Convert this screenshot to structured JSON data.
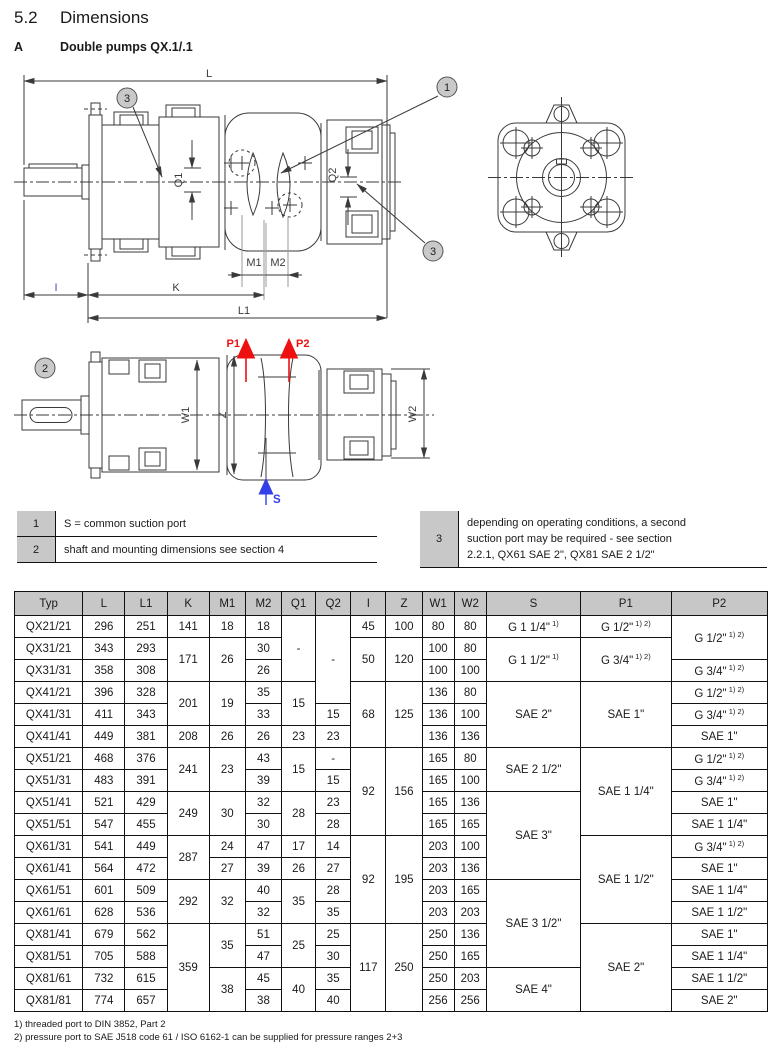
{
  "header": {
    "section_number": "5.2",
    "section_title": "Dimensions",
    "variant_letter": "A",
    "variant_title": "Double pumps QX.1/.1"
  },
  "drawing": {
    "dims": {
      "L": "L",
      "L1": "L1",
      "K": "K",
      "I": "I",
      "M1": "M1",
      "M2": "M2",
      "Q1": "Q1",
      "Q2": "Q2",
      "W1": "W1",
      "W2": "W2",
      "Z": "Z"
    },
    "ports": {
      "P1": "P1",
      "P2": "P2",
      "S": "S"
    },
    "callouts": {
      "c1": "1",
      "c2": "2",
      "c3": "3"
    },
    "colors": {
      "pressure_port": "#ee1010",
      "suction_port": "#3340e8",
      "line": "#3a3a3a",
      "callout_fill": "#c9c9c9",
      "header_gray": "#c7c7c7"
    }
  },
  "notes": {
    "left": [
      {
        "num": "1",
        "text": "S = common suction port"
      },
      {
        "num": "2",
        "text": "shaft and mounting dimensions see section 4"
      }
    ],
    "right": [
      {
        "num": "3",
        "lines": [
          "depending on operating conditions, a second",
          "suction port may be required - see section",
          "2.2.1, QX61 SAE 2\", QX81 SAE 2 1/2\""
        ]
      }
    ]
  },
  "table": {
    "headers": [
      "Typ",
      "L",
      "L1",
      "K",
      "M1",
      "M2",
      "Q1",
      "Q2",
      "I",
      "Z",
      "W1",
      "W2",
      "S",
      "P1",
      "P2"
    ],
    "rows": [
      [
        "QX21/21",
        "296",
        "251",
        "141",
        "18",
        "18",
        {
          "t": "-",
          "rs": 3
        },
        {
          "t": "-",
          "rs": 4
        },
        "45",
        "100",
        "80",
        "80",
        {
          "t": "G 1 1/4\"",
          "sup": "1)"
        },
        {
          "t": "G 1/2\"",
          "sup": "1) 2)"
        },
        {
          "t": "G 1/2\"",
          "sup": "1) 2)",
          "rs": 2
        }
      ],
      [
        "QX31/21",
        "343",
        "293",
        {
          "t": "171",
          "rs": 2
        },
        {
          "t": "26",
          "rs": 2
        },
        "30",
        null,
        null,
        {
          "t": "50",
          "rs": 2
        },
        {
          "t": "120",
          "rs": 2
        },
        "100",
        "80",
        {
          "t": "G 1 1/2\"",
          "sup": "1)",
          "rs": 2
        },
        {
          "t": "G 3/4\"",
          "sup": "1) 2)",
          "rs": 2
        },
        null
      ],
      [
        "QX31/31",
        "358",
        "308",
        null,
        null,
        "26",
        null,
        null,
        null,
        null,
        "100",
        "100",
        null,
        null,
        {
          "t": "G 3/4\"",
          "sup": "1) 2)"
        }
      ],
      [
        "QX41/21",
        "396",
        "328",
        {
          "t": "201",
          "rs": 2
        },
        {
          "t": "19",
          "rs": 2
        },
        "35",
        {
          "t": "15",
          "rs": 2
        },
        null,
        {
          "t": "68",
          "rs": 3
        },
        {
          "t": "125",
          "rs": 3
        },
        "136",
        "80",
        {
          "t": "SAE 2\"",
          "rs": 3
        },
        {
          "t": "SAE 1\"",
          "rs": 3
        },
        {
          "t": "G 1/2\"",
          "sup": "1) 2)"
        }
      ],
      [
        "QX41/31",
        "411",
        "343",
        null,
        null,
        "33",
        null,
        "15",
        null,
        null,
        "136",
        "100",
        null,
        null,
        {
          "t": "G 3/4\"",
          "sup": "1) 2)"
        }
      ],
      [
        "QX41/41",
        "449",
        "381",
        "208",
        "26",
        "26",
        "23",
        "23",
        null,
        null,
        "136",
        "136",
        null,
        null,
        "SAE 1\""
      ],
      [
        "QX51/21",
        "468",
        "376",
        {
          "t": "241",
          "rs": 2
        },
        {
          "t": "23",
          "rs": 2
        },
        "43",
        {
          "t": "15",
          "rs": 2
        },
        "-",
        {
          "t": "92",
          "rs": 4
        },
        {
          "t": "156",
          "rs": 4
        },
        "165",
        "80",
        {
          "t": "SAE 2 1/2\"",
          "rs": 2
        },
        {
          "t": "SAE 1 1/4\"",
          "rs": 4
        },
        {
          "t": "G 1/2\"",
          "sup": "1) 2)"
        }
      ],
      [
        "QX51/31",
        "483",
        "391",
        null,
        null,
        "39",
        null,
        "15",
        null,
        null,
        "165",
        "100",
        null,
        null,
        {
          "t": "G 3/4\"",
          "sup": "1) 2)"
        }
      ],
      [
        "QX51/41",
        "521",
        "429",
        {
          "t": "249",
          "rs": 2
        },
        {
          "t": "30",
          "rs": 2
        },
        "32",
        {
          "t": "28",
          "rs": 2
        },
        "23",
        null,
        null,
        "165",
        "136",
        {
          "t": "SAE 3\"",
          "rs": 4
        },
        null,
        "SAE 1\""
      ],
      [
        "QX51/51",
        "547",
        "455",
        null,
        null,
        "30",
        null,
        "28",
        null,
        null,
        "165",
        "165",
        null,
        null,
        "SAE 1 1/4\""
      ],
      [
        "QX61/31",
        "541",
        "449",
        {
          "t": "287",
          "rs": 2
        },
        "24",
        "47",
        "17",
        "14",
        {
          "t": "92",
          "rs": 4
        },
        {
          "t": "195",
          "rs": 4
        },
        "203",
        "100",
        null,
        {
          "t": "SAE 1 1/2\"",
          "rs": 4
        },
        {
          "t": "G 3/4\"",
          "sup": "1) 2)"
        }
      ],
      [
        "QX61/41",
        "564",
        "472",
        null,
        "27",
        "39",
        "26",
        "27",
        null,
        null,
        "203",
        "136",
        null,
        null,
        "SAE 1\""
      ],
      [
        "QX61/51",
        "601",
        "509",
        {
          "t": "292",
          "rs": 2
        },
        {
          "t": "32",
          "rs": 2
        },
        "40",
        {
          "t": "35",
          "rs": 2
        },
        "28",
        null,
        null,
        "203",
        "165",
        {
          "t": "SAE 3 1/2\"",
          "rs": 4
        },
        null,
        "SAE 1 1/4\""
      ],
      [
        "QX61/61",
        "628",
        "536",
        null,
        null,
        "32",
        null,
        "35",
        null,
        null,
        "203",
        "203",
        null,
        null,
        "SAE 1 1/2\""
      ],
      [
        "QX81/41",
        "679",
        "562",
        {
          "t": "359",
          "rs": 4
        },
        {
          "t": "35",
          "rs": 2
        },
        "51",
        {
          "t": "25",
          "rs": 2
        },
        "25",
        {
          "t": "117",
          "rs": 4
        },
        {
          "t": "250",
          "rs": 4
        },
        "250",
        "136",
        null,
        {
          "t": "SAE 2\"",
          "rs": 4
        },
        "SAE 1\""
      ],
      [
        "QX81/51",
        "705",
        "588",
        null,
        null,
        "47",
        null,
        "30",
        null,
        null,
        "250",
        "165",
        null,
        null,
        "SAE 1 1/4\""
      ],
      [
        "QX81/61",
        "732",
        "615",
        null,
        {
          "t": "38",
          "rs": 2
        },
        "45",
        {
          "t": "40",
          "rs": 2
        },
        "35",
        null,
        null,
        "250",
        "203",
        {
          "t": "SAE 4\"",
          "rs": 2
        },
        null,
        "SAE 1 1/2\""
      ],
      [
        "QX81/81",
        "774",
        "657",
        null,
        null,
        "38",
        null,
        "40",
        null,
        null,
        "256",
        "256",
        null,
        null,
        "SAE 2\""
      ]
    ]
  },
  "footnotes": [
    "1) threaded port to DIN 3852, Part 2",
    "2) pressure port to SAE J518 code 61 / ISO 6162-1 can be supplied for pressure ranges 2+3"
  ]
}
